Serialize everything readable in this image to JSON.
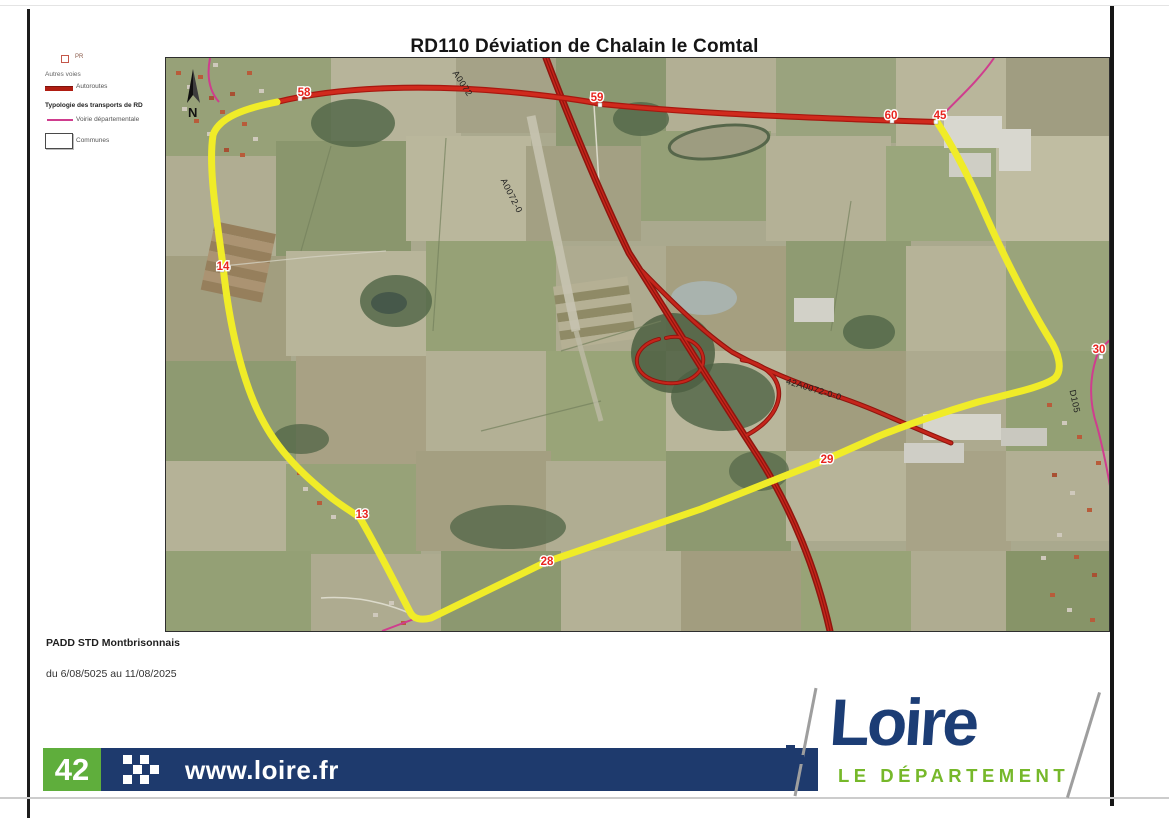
{
  "page": {
    "title": "RD110 Déviation de Chalain le Comtal"
  },
  "legend": {
    "pr_label": "PR",
    "autres_voies_label": "Autres voies",
    "autoroutes_label": "Autoroutes",
    "typologie_heading": "Typologie des transports de RD",
    "voirie_label": "Voirie départementale",
    "communes_label": "Communes"
  },
  "map": {
    "north_label": "N",
    "markers": [
      {
        "label": "58"
      },
      {
        "label": "59"
      },
      {
        "label": "60"
      },
      {
        "label": "45"
      },
      {
        "label": "14"
      },
      {
        "label": "13"
      },
      {
        "label": "28"
      },
      {
        "label": "29"
      },
      {
        "label": "30"
      }
    ],
    "road_labels": {
      "autoroute_top": "A0072",
      "autoroute_mid": "A0072-0",
      "ramp": "42A0072-0-0",
      "departementale": "D105"
    },
    "colors": {
      "deviation_yellow": "#f0ec28",
      "autoroute_red": "#c5251b",
      "departementale_pink": "#cf3d8e"
    }
  },
  "info": {
    "document_name": "PADD STD Montbrisonnais",
    "date_range": "du 6/08/5025 au 11/08/2025"
  },
  "footer": {
    "department_number": "42",
    "website": "www.loire.fr",
    "logo_title": "Loire",
    "logo_subtitle": "LE DÉPARTEMENT"
  }
}
